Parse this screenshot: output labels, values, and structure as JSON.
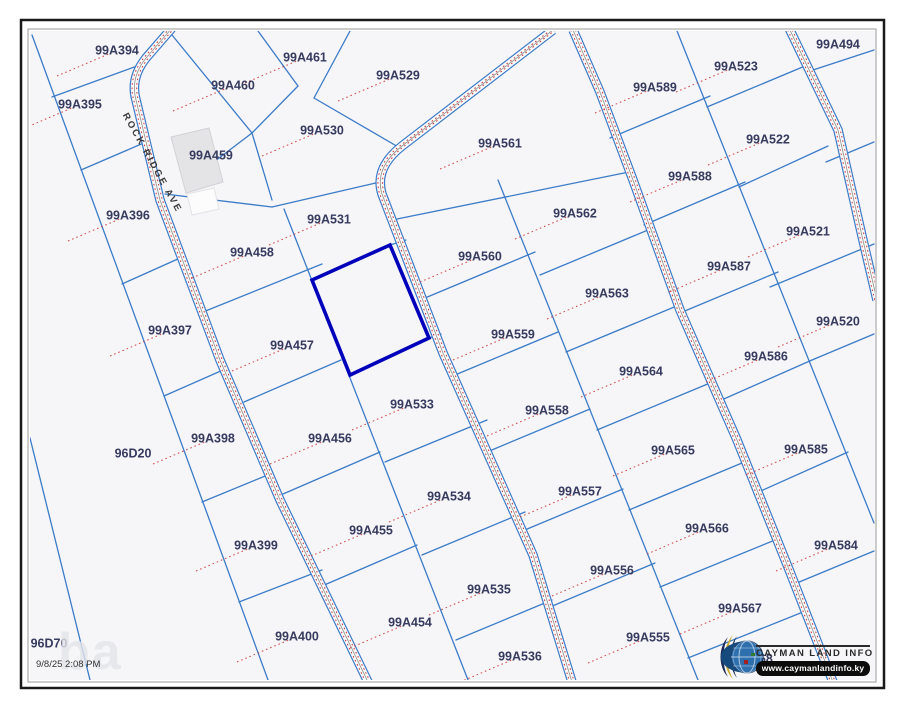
{
  "map": {
    "colors": {
      "map_bg": "#f6f6f8",
      "parcel_line": "#3b7bc8",
      "road_edge": "#3b7bc8",
      "road_fill": "#fbfbfc",
      "road_center": "#8f8f8a",
      "red_dots": "#cc3b3b",
      "label": "#363a5e",
      "highlight": "#0000bb",
      "frame_outer": "#1a1a1a",
      "frame_inner": "#999999",
      "building_fill": "#e4e4e7",
      "building_edge": "#d2d2d6"
    },
    "frame": {
      "outer": [
        21,
        20,
        863,
        668
      ],
      "inner": [
        28,
        29,
        848,
        653
      ],
      "clip": [
        30,
        31,
        845,
        649
      ]
    },
    "street": {
      "name": "ROCK RIDGE AVE"
    },
    "timestamp": "9/8/25 2:08 PM",
    "watermark": "ba",
    "hidden_parcel": "99A568",
    "logo": {
      "line1": "CAYMAN LAND INFO",
      "line2": "www.caymanlandinfo.ky",
      "globe": "globe-icon"
    },
    "selected_parcel": {
      "id": "99A532",
      "points": "312,280 390,245 429,338 350,375"
    },
    "building_footprint": {
      "points": "171,137 209,128 223,182 186,193",
      "annex_points": "187,194 214,188 219,209 192,215"
    },
    "parcels": [
      {
        "id": "99A394",
        "x": 117,
        "y": 50
      },
      {
        "id": "99A395",
        "x": 80,
        "y": 104
      },
      {
        "id": "99A396",
        "x": 128,
        "y": 215
      },
      {
        "id": "99A397",
        "x": 170,
        "y": 330
      },
      {
        "id": "99A398",
        "x": 213,
        "y": 438
      },
      {
        "id": "99A399",
        "x": 256,
        "y": 545
      },
      {
        "id": "99A400",
        "x": 297,
        "y": 636
      },
      {
        "id": "96D20",
        "x": 133,
        "y": 453,
        "tick": false
      },
      {
        "id": "96D70",
        "x": 49,
        "y": 643,
        "tick": false
      },
      {
        "id": "99A460",
        "x": 233,
        "y": 85
      },
      {
        "id": "99A461",
        "x": 305,
        "y": 57
      },
      {
        "id": "99A459",
        "x": 211,
        "y": 155,
        "tick": false
      },
      {
        "id": "99A529",
        "x": 398,
        "y": 75
      },
      {
        "id": "99A530",
        "x": 322,
        "y": 130
      },
      {
        "id": "99A531",
        "x": 329,
        "y": 219
      },
      {
        "id": "99A458",
        "x": 252,
        "y": 252
      },
      {
        "id": "99A457",
        "x": 292,
        "y": 345
      },
      {
        "id": "99A456",
        "x": 330,
        "y": 438
      },
      {
        "id": "99A455",
        "x": 371,
        "y": 530
      },
      {
        "id": "99A454",
        "x": 410,
        "y": 622
      },
      {
        "id": "99A533",
        "x": 412,
        "y": 404
      },
      {
        "id": "99A534",
        "x": 449,
        "y": 496
      },
      {
        "id": "99A535",
        "x": 489,
        "y": 589
      },
      {
        "id": "99A536",
        "x": 520,
        "y": 656
      },
      {
        "id": "99A561",
        "x": 500,
        "y": 143
      },
      {
        "id": "99A560",
        "x": 480,
        "y": 256
      },
      {
        "id": "99A559",
        "x": 513,
        "y": 334
      },
      {
        "id": "99A558",
        "x": 547,
        "y": 410
      },
      {
        "id": "99A557",
        "x": 580,
        "y": 491
      },
      {
        "id": "99A556",
        "x": 612,
        "y": 570
      },
      {
        "id": "99A555",
        "x": 648,
        "y": 637
      },
      {
        "id": "99A562",
        "x": 575,
        "y": 213
      },
      {
        "id": "99A563",
        "x": 607,
        "y": 293
      },
      {
        "id": "99A564",
        "x": 641,
        "y": 371
      },
      {
        "id": "99A565",
        "x": 673,
        "y": 450
      },
      {
        "id": "99A566",
        "x": 707,
        "y": 528
      },
      {
        "id": "99A567",
        "x": 740,
        "y": 608
      },
      {
        "id": "99A589",
        "x": 655,
        "y": 87
      },
      {
        "id": "99A588",
        "x": 690,
        "y": 176
      },
      {
        "id": "99A587",
        "x": 729,
        "y": 266
      },
      {
        "id": "99A586",
        "x": 766,
        "y": 356
      },
      {
        "id": "99A585",
        "x": 806,
        "y": 449
      },
      {
        "id": "99A584",
        "x": 836,
        "y": 545
      },
      {
        "id": "99A523",
        "x": 736,
        "y": 66
      },
      {
        "id": "99A522",
        "x": 768,
        "y": 139
      },
      {
        "id": "99A521",
        "x": 808,
        "y": 231
      },
      {
        "id": "99A520",
        "x": 838,
        "y": 321
      },
      {
        "id": "99A494",
        "x": 838,
        "y": 44,
        "tick": false
      }
    ],
    "roads": [
      {
        "name": "ROCK RIDGE AVE",
        "path": "M 172,28 L 146,58 Q 130,78 136,100 L 160,200 L 220,360 L 280,500 L 368,682"
      },
      {
        "name": "",
        "path": "M 553,30 L 402,146 Q 374,168 382,194 L 443,353 L 533,555 L 572,682"
      },
      {
        "name": "",
        "path": "M 573,30 L 600,92 L 633,180 L 680,310 L 737,440 L 790,572 L 833,682"
      },
      {
        "name": "",
        "path": "M 788,26 L 838,130 L 862,236 L 877,300"
      }
    ],
    "boundaries": [
      [
        32,
        35,
        268,
        680
      ],
      [
        30,
        438,
        90,
        680
      ],
      [
        52,
        97,
        148,
        62
      ],
      [
        81,
        170,
        146,
        142
      ],
      [
        122,
        284,
        180,
        258
      ],
      [
        164,
        396,
        223,
        370
      ],
      [
        202,
        502,
        270,
        474
      ],
      [
        239,
        602,
        322,
        570
      ],
      [
        172,
        35,
        252,
        133
      ],
      [
        258,
        31,
        298,
        86
      ],
      [
        298,
        86,
        252,
        133
      ],
      [
        350,
        31,
        314,
        98
      ],
      [
        314,
        98,
        400,
        148
      ],
      [
        252,
        133,
        206,
        168
      ],
      [
        252,
        133,
        272,
        200
      ],
      [
        165,
        194,
        272,
        207
      ],
      [
        272,
        207,
        380,
        182
      ],
      [
        284,
        209,
        468,
        680
      ],
      [
        203,
        312,
        322,
        264
      ],
      [
        244,
        402,
        341,
        360
      ],
      [
        283,
        494,
        380,
        452
      ],
      [
        322,
        586,
        417,
        545
      ],
      [
        390,
        245,
        406,
        240
      ],
      [
        429,
        338,
        441,
        334
      ],
      [
        385,
        462,
        487,
        420
      ],
      [
        422,
        555,
        525,
        512
      ],
      [
        456,
        640,
        552,
        600
      ],
      [
        498,
        180,
        698,
        680
      ],
      [
        392,
        220,
        629,
        172
      ],
      [
        425,
        298,
        535,
        252
      ],
      [
        455,
        375,
        558,
        332
      ],
      [
        487,
        452,
        590,
        409
      ],
      [
        520,
        532,
        623,
        489
      ],
      [
        550,
        607,
        655,
        563
      ],
      [
        540,
        275,
        648,
        230
      ],
      [
        566,
        352,
        679,
        305
      ],
      [
        597,
        430,
        710,
        383
      ],
      [
        629,
        510,
        742,
        463
      ],
      [
        660,
        587,
        775,
        540
      ],
      [
        688,
        658,
        803,
        612
      ],
      [
        677,
        31,
        874,
        523
      ],
      [
        610,
        138,
        710,
        96
      ],
      [
        644,
        225,
        745,
        182
      ],
      [
        680,
        313,
        778,
        272
      ],
      [
        717,
        402,
        812,
        360
      ],
      [
        754,
        494,
        848,
        452
      ],
      [
        792,
        585,
        874,
        551
      ],
      [
        707,
        107,
        805,
        66
      ],
      [
        739,
        187,
        828,
        146
      ],
      [
        770,
        287,
        874,
        244
      ],
      [
        812,
        360,
        874,
        334
      ],
      [
        813,
        70,
        874,
        50
      ],
      [
        826,
        162,
        874,
        142
      ]
    ]
  }
}
